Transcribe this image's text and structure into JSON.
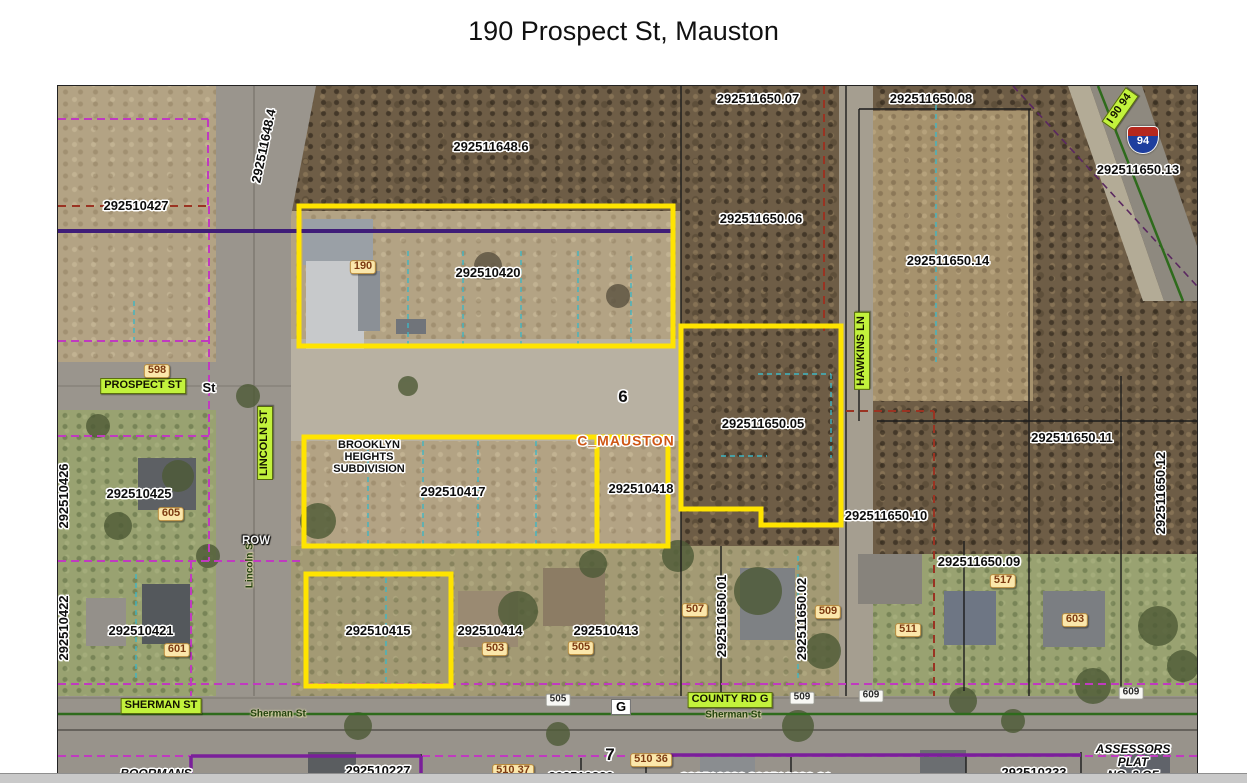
{
  "title": "190 Prospect St, Mauston",
  "map": {
    "colors": {
      "highlight_parcel_outline": "#ffe400",
      "street_label_background": "#c2f23c",
      "address_label_background": "#fbe7ab",
      "municipal_boundary_purple": "#3f1d78",
      "subdivision_boundary_magenta": "#c03ac0",
      "survey_line_red": "#9a3322",
      "utility_line_cyan": "#3fb6c4"
    },
    "shield": {
      "text": "94",
      "x": 1085,
      "y": 54
    },
    "labels": [
      {
        "text": "292511648.4",
        "x": 206,
        "y": 60,
        "rot": -78,
        "type": "parcel"
      },
      {
        "text": "292510427",
        "x": 78,
        "y": 120,
        "type": "parcel"
      },
      {
        "text": "292511648.6",
        "x": 433,
        "y": 61,
        "type": "parcel"
      },
      {
        "text": "292510420",
        "x": 430,
        "y": 187,
        "type": "parcel"
      },
      {
        "text": "292511650.07",
        "x": 700,
        "y": 13,
        "type": "parcel"
      },
      {
        "text": "292511650.08",
        "x": 873,
        "y": 13,
        "type": "parcel"
      },
      {
        "text": "292511650.06",
        "x": 703,
        "y": 133,
        "type": "parcel"
      },
      {
        "text": "292511650.14",
        "x": 890,
        "y": 175,
        "type": "parcel"
      },
      {
        "text": "292511650.13",
        "x": 1080,
        "y": 84,
        "type": "parcel"
      },
      {
        "text": "292511650.05",
        "x": 705,
        "y": 338,
        "type": "parcel"
      },
      {
        "text": "292510426",
        "x": 6,
        "y": 410,
        "rot": -90,
        "type": "parcel"
      },
      {
        "text": "292510425",
        "x": 81,
        "y": 408,
        "type": "parcel"
      },
      {
        "text": "292510417",
        "x": 395,
        "y": 406,
        "type": "parcel"
      },
      {
        "text": "292510418",
        "x": 583,
        "y": 403,
        "type": "parcel"
      },
      {
        "text": "292511650.10",
        "x": 828,
        "y": 430,
        "type": "parcel"
      },
      {
        "text": "292511650.11",
        "x": 1014,
        "y": 352,
        "type": "parcel"
      },
      {
        "text": "292511650.12",
        "x": 1103,
        "y": 407,
        "rot": -90,
        "type": "parcel"
      },
      {
        "text": "292510422",
        "x": 6,
        "y": 542,
        "rot": -90,
        "type": "parcel"
      },
      {
        "text": "292510421",
        "x": 83,
        "y": 545,
        "type": "parcel"
      },
      {
        "text": "292510415",
        "x": 320,
        "y": 545,
        "type": "parcel"
      },
      {
        "text": "292510414",
        "x": 432,
        "y": 545,
        "type": "parcel"
      },
      {
        "text": "292510413",
        "x": 548,
        "y": 545,
        "type": "parcel"
      },
      {
        "text": "292511650.01",
        "x": 664,
        "y": 530,
        "rot": -90,
        "type": "parcel"
      },
      {
        "text": "292511650.02",
        "x": 744,
        "y": 533,
        "rot": -90,
        "type": "parcel"
      },
      {
        "text": "292511650.09",
        "x": 921,
        "y": 476,
        "type": "parcel"
      },
      {
        "text": "292510227",
        "x": 320,
        "y": 685,
        "type": "parcel"
      },
      {
        "text": "292510233",
        "x": 976,
        "y": 687,
        "type": "parcel"
      },
      {
        "text": "292510229",
        "x": 523,
        "y": 691,
        "type": "parcel"
      },
      {
        "text": "292510230",
        "x": 655,
        "y": 692,
        "type": "parcel"
      },
      {
        "text": "292510230.01",
        "x": 732,
        "y": 692,
        "type": "parcel"
      },
      {
        "text": "PROSPECT ST",
        "x": 85,
        "y": 300,
        "type": "street"
      },
      {
        "text": "LINCOLN ST",
        "x": 207,
        "y": 357,
        "rot": -90,
        "type": "street"
      },
      {
        "text": "HAWKINS LN",
        "x": 804,
        "y": 265,
        "rot": -90,
        "type": "street"
      },
      {
        "text": "SHERMAN ST",
        "x": 103,
        "y": 620,
        "type": "street"
      },
      {
        "text": "COUNTY RD G",
        "x": 672,
        "y": 614,
        "type": "street"
      },
      {
        "text": "I 90 94",
        "x": 1062,
        "y": 23,
        "rot": -55,
        "type": "street"
      },
      {
        "text": "190",
        "x": 305,
        "y": 181,
        "type": "house"
      },
      {
        "text": "598",
        "x": 99,
        "y": 285,
        "type": "house"
      },
      {
        "text": "605",
        "x": 113,
        "y": 428,
        "type": "house"
      },
      {
        "text": "601",
        "x": 119,
        "y": 564,
        "type": "house"
      },
      {
        "text": "503",
        "x": 437,
        "y": 563,
        "type": "house"
      },
      {
        "text": "505",
        "x": 523,
        "y": 562,
        "type": "house"
      },
      {
        "text": "507",
        "x": 637,
        "y": 524,
        "type": "house"
      },
      {
        "text": "509",
        "x": 770,
        "y": 526,
        "type": "house"
      },
      {
        "text": "511",
        "x": 850,
        "y": 544,
        "type": "house"
      },
      {
        "text": "517",
        "x": 945,
        "y": 495,
        "type": "house"
      },
      {
        "text": "603",
        "x": 1017,
        "y": 534,
        "type": "house"
      },
      {
        "text": "510 37",
        "x": 455,
        "y": 685,
        "type": "house"
      },
      {
        "text": "510 36",
        "x": 593,
        "y": 674,
        "type": "house"
      },
      {
        "text": "505",
        "x": 500,
        "y": 614,
        "type": "roadtag"
      },
      {
        "text": "509",
        "x": 744,
        "y": 612,
        "type": "roadtag"
      },
      {
        "text": "609",
        "x": 813,
        "y": 610,
        "type": "roadtag"
      },
      {
        "text": "609",
        "x": 1073,
        "y": 607,
        "type": "roadtag"
      },
      {
        "text": "St",
        "x": 151,
        "y": 302,
        "type": "parcel"
      },
      {
        "text": "Sherman St",
        "x": 220,
        "y": 629,
        "type": "roadname"
      },
      {
        "text": "Sherman St",
        "x": 675,
        "y": 630,
        "type": "roadname"
      },
      {
        "text": "Lincoln St",
        "x": 193,
        "y": 478,
        "rot": -90,
        "type": "roadname"
      },
      {
        "text": "6",
        "x": 565,
        "y": 311,
        "type": "section"
      },
      {
        "text": "7",
        "x": 552,
        "y": 669,
        "type": "section"
      },
      {
        "text": "C_MAUSTON",
        "x": 568,
        "y": 355,
        "type": "orange"
      },
      {
        "text": "BROOKLYN\nHEIGHTS\nSUBDIVISION",
        "x": 311,
        "y": 372,
        "type": "subdivision"
      },
      {
        "text": "ROW",
        "x": 198,
        "y": 455,
        "type": "row"
      },
      {
        "text": "G",
        "x": 563,
        "y": 621,
        "type": "gbox"
      },
      {
        "text": "BOORMANS",
        "x": 98,
        "y": 688,
        "type": "plat"
      },
      {
        "text": "ASSESSORS PLAT\nNO. 3 OF CITY",
        "x": 1075,
        "y": 683,
        "type": "plat"
      }
    ]
  }
}
